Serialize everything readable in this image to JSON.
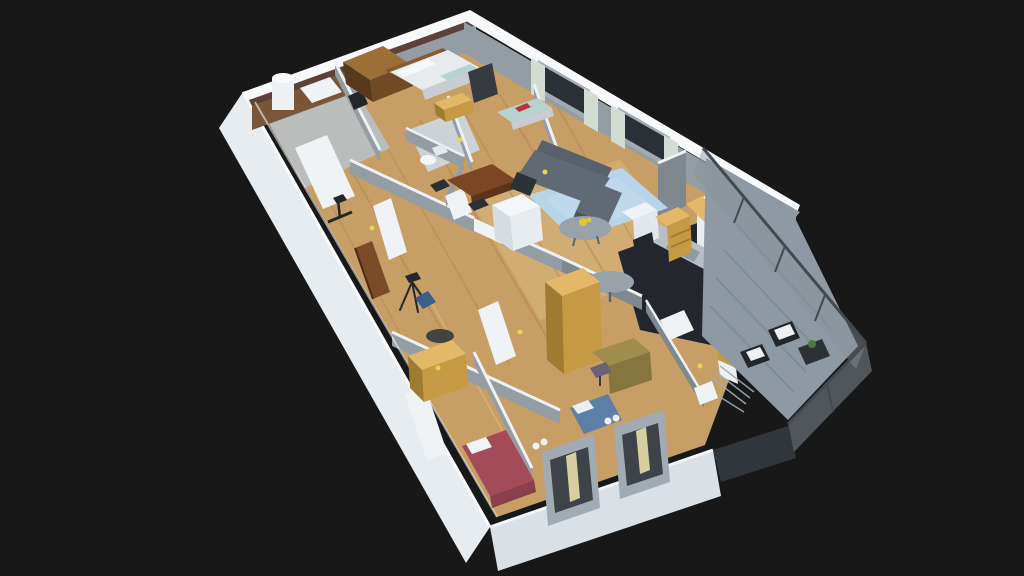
{
  "scene": {
    "type": "isometric-3d-apartment-floorplan-render",
    "background": "#181818",
    "objects": [
      "outer-walls",
      "wood-floor",
      "bathroom",
      "boiler",
      "bathroom-cabinet",
      "brown-wardrobe",
      "double-bed",
      "tv-panel",
      "teal-single-bed",
      "nightstand-yellow",
      "wc-toilet",
      "hall-closet",
      "front-door",
      "tripod",
      "exercise-bike",
      "dining-table",
      "dining-chairs",
      "structural-column",
      "sofa",
      "rug",
      "coffee-table",
      "window-curtains",
      "kitchen-floor",
      "kitchen-counter",
      "fridge",
      "shelf-unit-yellow",
      "bar-counter-yellow",
      "oval-bar-table",
      "bar-stools",
      "office-wardrobe-yellow",
      "office-desk",
      "office-chair",
      "blue-bed",
      "bedroom-wardrobe-yellow",
      "red-bed",
      "se-window-boxes",
      "balcony-floor",
      "balcony-glass-railing",
      "drying-rack",
      "wicker-chairs",
      "balcony-table",
      "balcony-plant"
    ]
  },
  "palette": {
    "bg": "#181818",
    "wall_white_top": "#f7f9fb",
    "wall_white_face": "#e7ecf0",
    "wall_white_face_shade": "#d9e0e6",
    "wall_gray_face": "#949ca4",
    "wall_gray_face_dark": "#7f878f",
    "wall_brown_top": "#5f4038",
    "panel_brown": "#7b5538",
    "wood_floor": "#c79e66",
    "wood_streak": "#a97f47",
    "wood_light": "#e6c68d",
    "tile_floor": "#b9c0c5",
    "tile_wc": "#ccd3d7",
    "kitchen_floor": "#23272d",
    "balcony_floor": "#8e99a3",
    "balcony_stripe": "#7b8791",
    "glass": "#8a939c",
    "glass_frame": "#43494f",
    "glass_dark": "#343a40",
    "sofa_top": "#606a75",
    "sofa_front": "#4b545e",
    "sofa_back": "#57606b",
    "rug": "#b7d5e9",
    "coffee_table": "#98a2ab",
    "dining_table": "#7c4524",
    "chair_dark": "#2c3136",
    "tv_panel": "#363b42",
    "bed_white": "#e8ebee",
    "bed_shadow": "#c7cdd3",
    "headboard": "#8a5a30",
    "bed_teal": "#b5d4cf",
    "item_red": "#b8343f",
    "item_blue": "#3a5f8a",
    "bed_red": "#a34b59",
    "bed_red_side": "#8a3f4c",
    "bed_blue": "#5c7fa7",
    "wardrobe_top": "#e3b868",
    "wardrobe_face": "#c69a44",
    "wardrobe_side": "#9f7b32",
    "wardrobe_brown_top": "#9c6e38",
    "wardrobe_brown_face": "#6f4a22",
    "wardrobe_brown_side": "#583a1a",
    "counter_gray": "#b6bec6",
    "counter_inset": "#8f99a2",
    "fridge": "#f0f3f5",
    "boiler": "#eef1f3",
    "door_brown": "#7b4a26",
    "door_white": "#f0f3f6",
    "curtain": "#d3dcd2",
    "curtain_yellow": "#d8cfa0",
    "window_dark": "#2b3036",
    "metal": "#a2abb3",
    "sticker": "#e8d44d",
    "flower": "#e7c52e",
    "plant": "#4d7a3a",
    "dark_object": "#23262b",
    "desk": "#a08c4f",
    "desk_front": "#87753f",
    "chair_purple": "#6b6277",
    "column_white": "#f4f7f9",
    "column_side": "#d6dde2",
    "white_base": "#eef1f4"
  }
}
